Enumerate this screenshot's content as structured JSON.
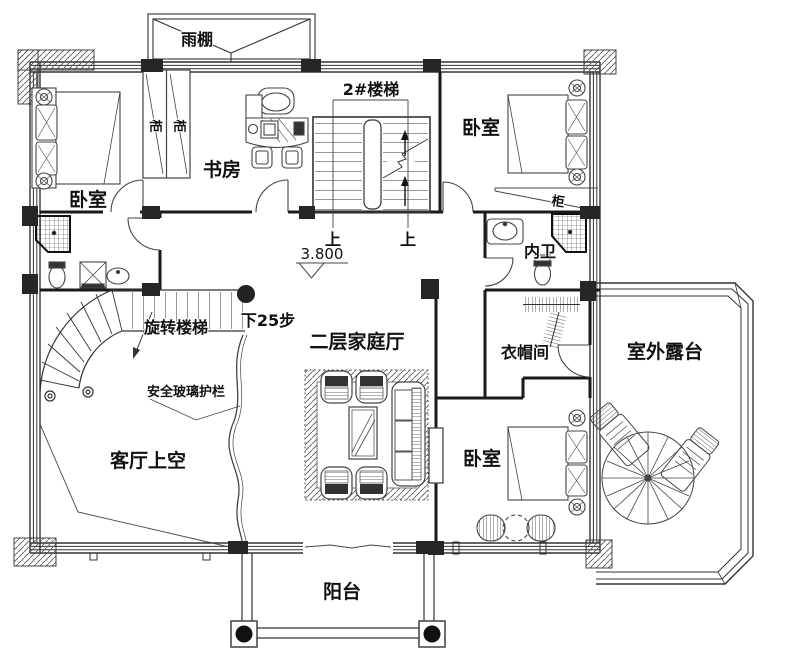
{
  "labels": {
    "canopy": "雨棚",
    "bedroom_top_left": "卧室",
    "wardrobe_cell_1": "柜",
    "wardrobe_cell_2": "柜",
    "study": "书房",
    "stair_2": "2#楼梯",
    "bedroom_top_right": "卧室",
    "cabinet": "柜",
    "up_1": "上",
    "up_2": "上",
    "elevation": "3.800",
    "inner_bath": "内卫",
    "spiral_stair": "旋转楼梯",
    "down_25_steps": "下25步",
    "safety_glass_rail": "安全玻璃护栏",
    "family_hall": "二层家庭厅",
    "cloakroom": "衣帽间",
    "terrace": "室外露台",
    "living_room_void": "客厅上空",
    "bedroom_bottom_right": "卧室",
    "balcony": "阳台"
  },
  "colors": {
    "wall": "#1a1a1a",
    "line": "#444444",
    "column": "#262626",
    "background": "#ffffff"
  }
}
